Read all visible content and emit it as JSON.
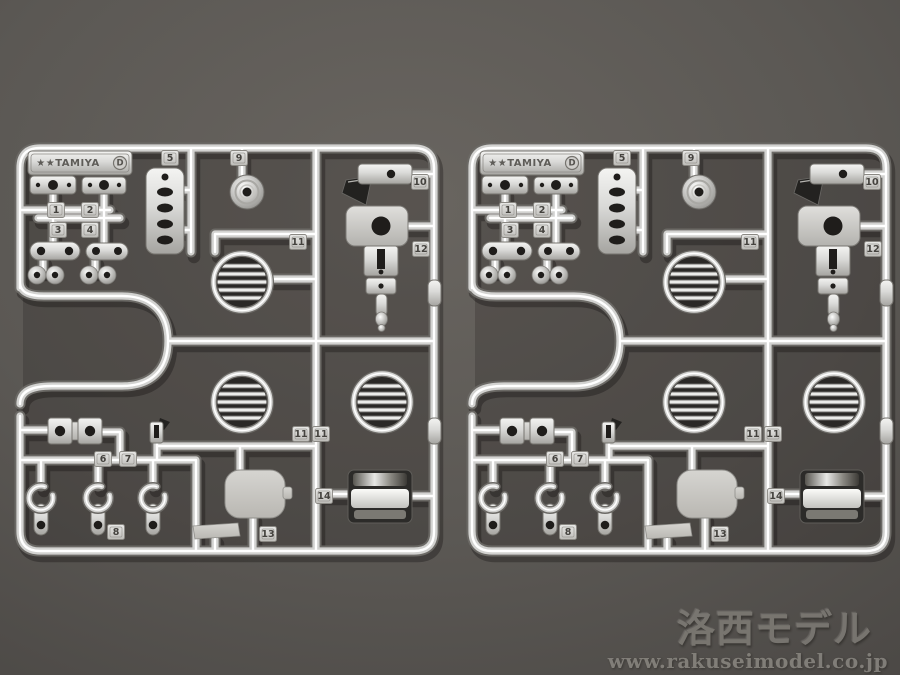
{
  "scene": {
    "background_color": "#5a5753",
    "background_vignette": "#4b4845",
    "chrome_color": "#d2d2d0",
    "sprue_count": 2
  },
  "sprue": {
    "logo": {
      "text": "★★TAMIYA",
      "mark": "D"
    },
    "tags": {
      "n1": "1",
      "n2": "2",
      "n3": "3",
      "n4": "4",
      "n5": "5",
      "n6": "6",
      "n7": "7",
      "n8": "8",
      "n9": "9",
      "n10": "10",
      "n11a": "11",
      "n11b": "11",
      "n11c": "11",
      "n12": "12",
      "n13": "13",
      "n14": "14"
    }
  },
  "watermark": {
    "title": "洛西モデル",
    "url": "www.rakuseimodel.co.jp"
  }
}
